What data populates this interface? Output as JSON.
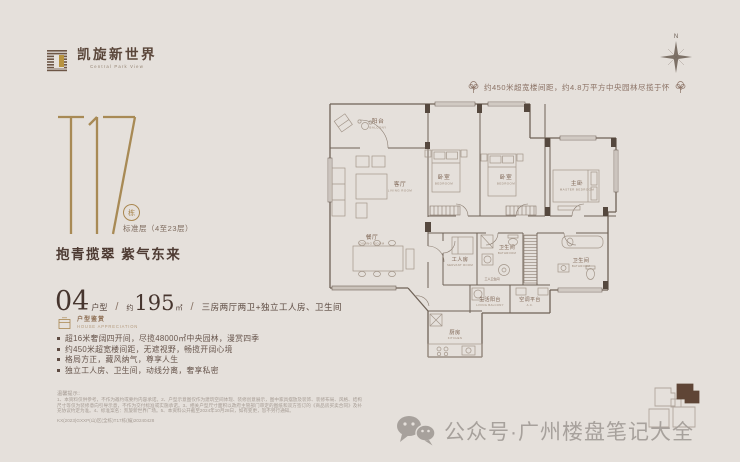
{
  "brand": {
    "name": "凯旋新世界",
    "name_en": "Central Park View"
  },
  "tower": {
    "code": "T17",
    "dong": "栋",
    "floors": "标准层（4至23层）"
  },
  "slogan": "抱青揽翠 紫气东来",
  "unit": {
    "number": "04",
    "label": "户型",
    "sep": "/",
    "approx": "约",
    "area": "195",
    "unit": "㎡",
    "desc": "三房两厅两卫+独立工人房、卫生间"
  },
  "appreciation": {
    "title": "户型鉴赏",
    "title_en": "HOUSE APPRECIATION",
    "bullets": [
      "超16米奢阔四开间，尽揽48000㎡中央园林，漫赏四季",
      "约450米超宽楼间距，无遮视野，畅揽开阔心境",
      "格局方正，藏风纳气，尊享人生",
      "独立工人房、卫生间，动线分离，奢享私密"
    ]
  },
  "annotation": {
    "text": "约450米超宽楼间距，约4.8万平方中央园林尽揽于怀"
  },
  "compass": {
    "n": "N"
  },
  "floorplan": {
    "rooms": [
      {
        "zh": "阳台",
        "en": "BALCONY"
      },
      {
        "zh": "客厅",
        "en": "LIVING ROOM"
      },
      {
        "zh": "餐厅",
        "en": "DINING ROOM"
      },
      {
        "zh": "卧室",
        "en": "BEDROOM"
      },
      {
        "zh": "卧室",
        "en": "BEDROOM"
      },
      {
        "zh": "主卧",
        "en": "MASTER BEDROOM"
      },
      {
        "zh": "工人房",
        "en": "SERVANT ROOM"
      },
      {
        "zh": "卫生间",
        "en": "BATHROOM"
      },
      {
        "zh": "卫生间",
        "en": "BATHROOM"
      },
      {
        "zh": "生活阳台",
        "en": "LIVING BALCONY"
      },
      {
        "zh": "空调平台",
        "en": "A.C."
      },
      {
        "zh": "厨房",
        "en": "KITCHEN"
      },
      {
        "zh": "工人卫生间",
        "en": ""
      }
    ]
  },
  "disclaimer": {
    "title": "温馨提示：",
    "body": "1、本资料仅供参考，不作为邀约或要约内容承诺。2、户型示意图仅作为建筑空间体现、装修创意展示，图中家具摆放及装饰、装修布局、风格、结构尺寸等仅为装修意向引导示意，不作为交付标准或实施承诺。3、相关户型尺寸面积以政府主管部门审定的图纸和双方签订的《商品房买卖合同》及补充协议约定为准。4、标准案名：凯旋新世界广场。5、本资料公开截至2024年10月28日，如有变更，恕不另行通知。",
    "code": "KX(2023)GXXP(山)区(全栋)T17栋(编)20240428"
  },
  "watermark": {
    "text": "公众号·广州楼盘笔记大全"
  },
  "colors": {
    "accent_gold": "#a98750",
    "text_brown": "#4e3b33",
    "plan_line": "#6f6257",
    "watermark": "#a7a19c",
    "background": "#e5e0db"
  }
}
